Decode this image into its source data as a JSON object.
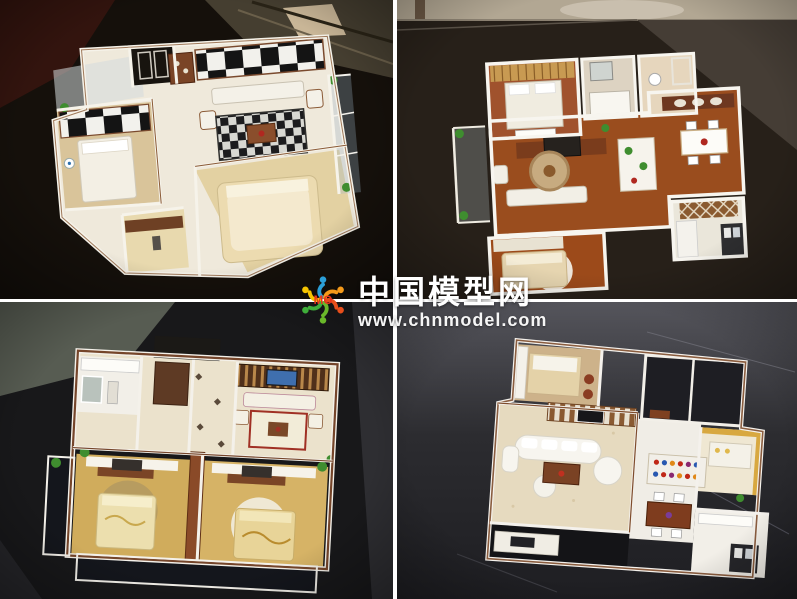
{
  "watermark": {
    "site_name": "中国模型网",
    "site_url": "www.chnmodel.com",
    "logo_text": "MO",
    "text_color": "#ffffff",
    "logo_colors": [
      "#2b9fd8",
      "#f59a1a",
      "#e84e1b",
      "#6ab82a",
      "#3fae3a",
      "#f5c400"
    ]
  },
  "collage": {
    "rows": 2,
    "cols": 2,
    "divider_color": "#ffffff",
    "photos": [
      {
        "id": "top-left",
        "label": "Apartment interior scale model, white walls, black-and-white checkered feature walls, beige beds, dark glass table background"
      },
      {
        "id": "top-right",
        "label": "Apartment interior scale model, white walls, red-brown wood floors, dining table and kitchen, dark table background"
      },
      {
        "id": "bottom-left",
        "label": "Apartment interior scale model, brown wall caps, twin bedrooms with golden floors, balcony plants, dark background"
      },
      {
        "id": "bottom-right",
        "label": "Apartment interior scale model, curved white sofa living room, marble floor, scratched dark table background"
      }
    ]
  },
  "palette": {
    "wall_white": "#f4f1ea",
    "wall_cap_brown": "#75452a",
    "wood_floor": "#9a4d1e",
    "gold_floor": "#d2ae5e",
    "cream_floor": "#ebe2cc",
    "table_dark": "#1a1714",
    "plant_green": "#3f8d2f"
  }
}
